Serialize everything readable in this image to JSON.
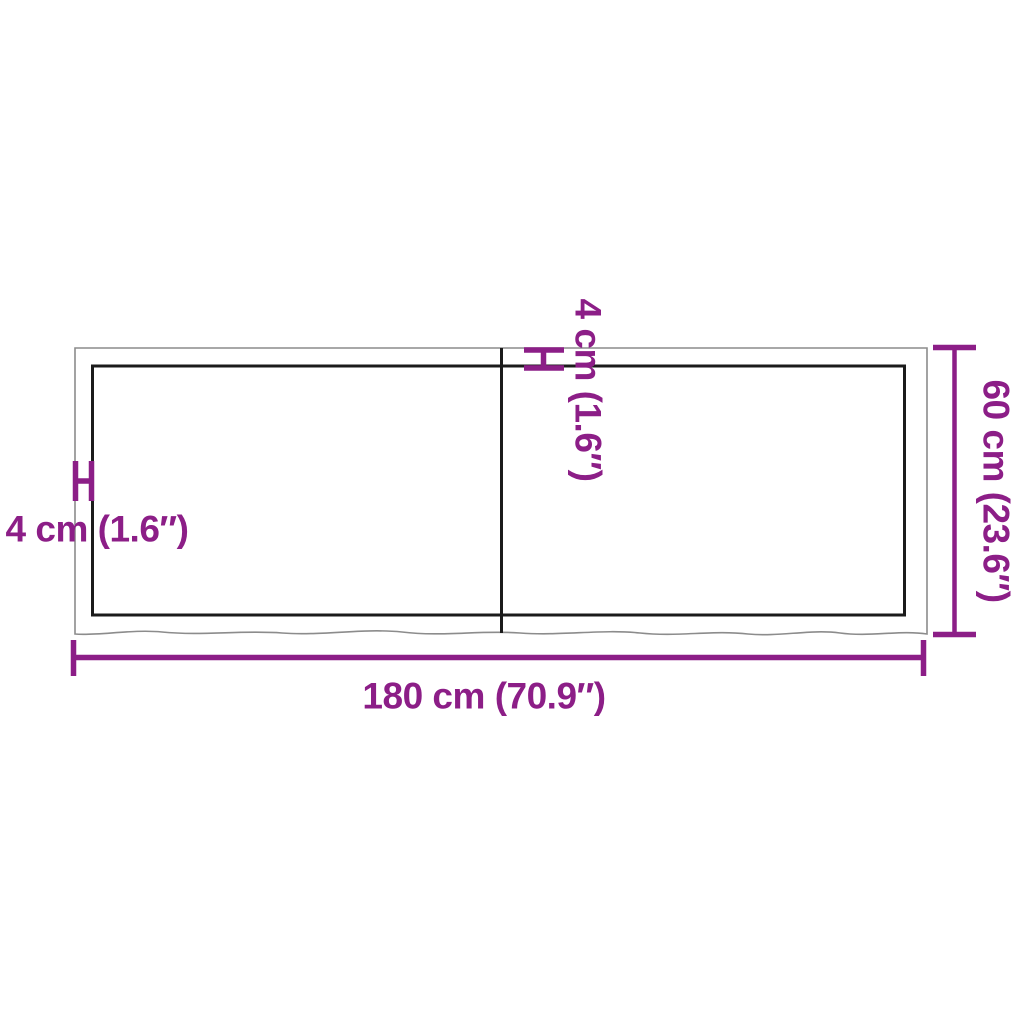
{
  "diagram": {
    "kind": "tabletop-dimension-diagram",
    "labels": {
      "width": "180 cm (70.9″)",
      "depth": "60 cm (23.6″)",
      "thickness_side": "4 cm (1.6″)",
      "thickness_top": "4 cm (1.6″)"
    },
    "colors": {
      "dimension_accent": "#8C1E87",
      "outer_outline": "#8C8C8C",
      "inner_outline": "#1B1B1B",
      "background": "#FFFFFF"
    }
  }
}
